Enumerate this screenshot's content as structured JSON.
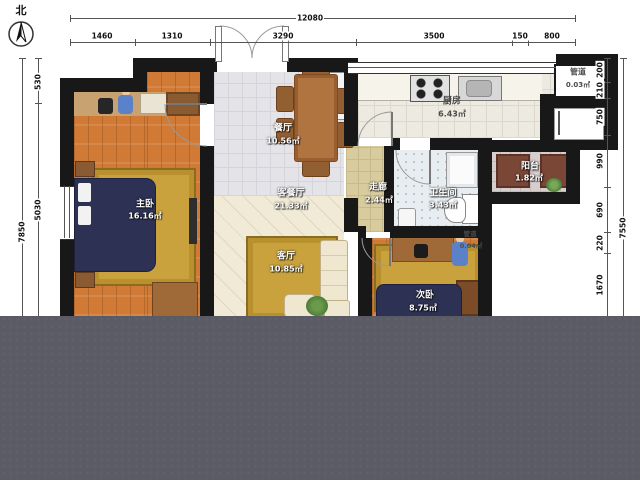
{
  "compass": {
    "label": "北"
  },
  "dims": {
    "top_total": "12080",
    "top_segments": [
      "1460",
      "1310",
      "3290",
      "3500",
      "150",
      "800"
    ],
    "left_total": "7850",
    "left_segments": [
      "530",
      "5030"
    ],
    "right_total": "7550",
    "right_segments": [
      "200",
      "210",
      "750",
      "990",
      "690",
      "220",
      "1670"
    ]
  },
  "rooms": [
    {
      "name": "厨房",
      "area": "6.43㎡"
    },
    {
      "name": "餐厅",
      "area": "10.56㎡"
    },
    {
      "name": "客餐厅",
      "area": "21.33㎡"
    },
    {
      "name": "客厅",
      "area": "10.85㎡"
    },
    {
      "name": "走廊",
      "area": "2.44㎡"
    },
    {
      "name": "卫生间",
      "area": "3.43㎡"
    },
    {
      "name": "主卧",
      "area": "16.16㎡"
    },
    {
      "name": "次卧",
      "area": "8.75㎡"
    },
    {
      "name": "阳台",
      "area": "1.82㎡"
    },
    {
      "name": "管道",
      "area": "0.03㎡"
    },
    {
      "name": "管道",
      "area": "0.04㎡"
    }
  ],
  "colors": {
    "wall": "#181818",
    "overlay": "#5b5b65",
    "wood_floor": "#d07a36",
    "rug": "#c9a23e",
    "bed": "#2d3254",
    "figure_blue": "#5b82c8"
  }
}
